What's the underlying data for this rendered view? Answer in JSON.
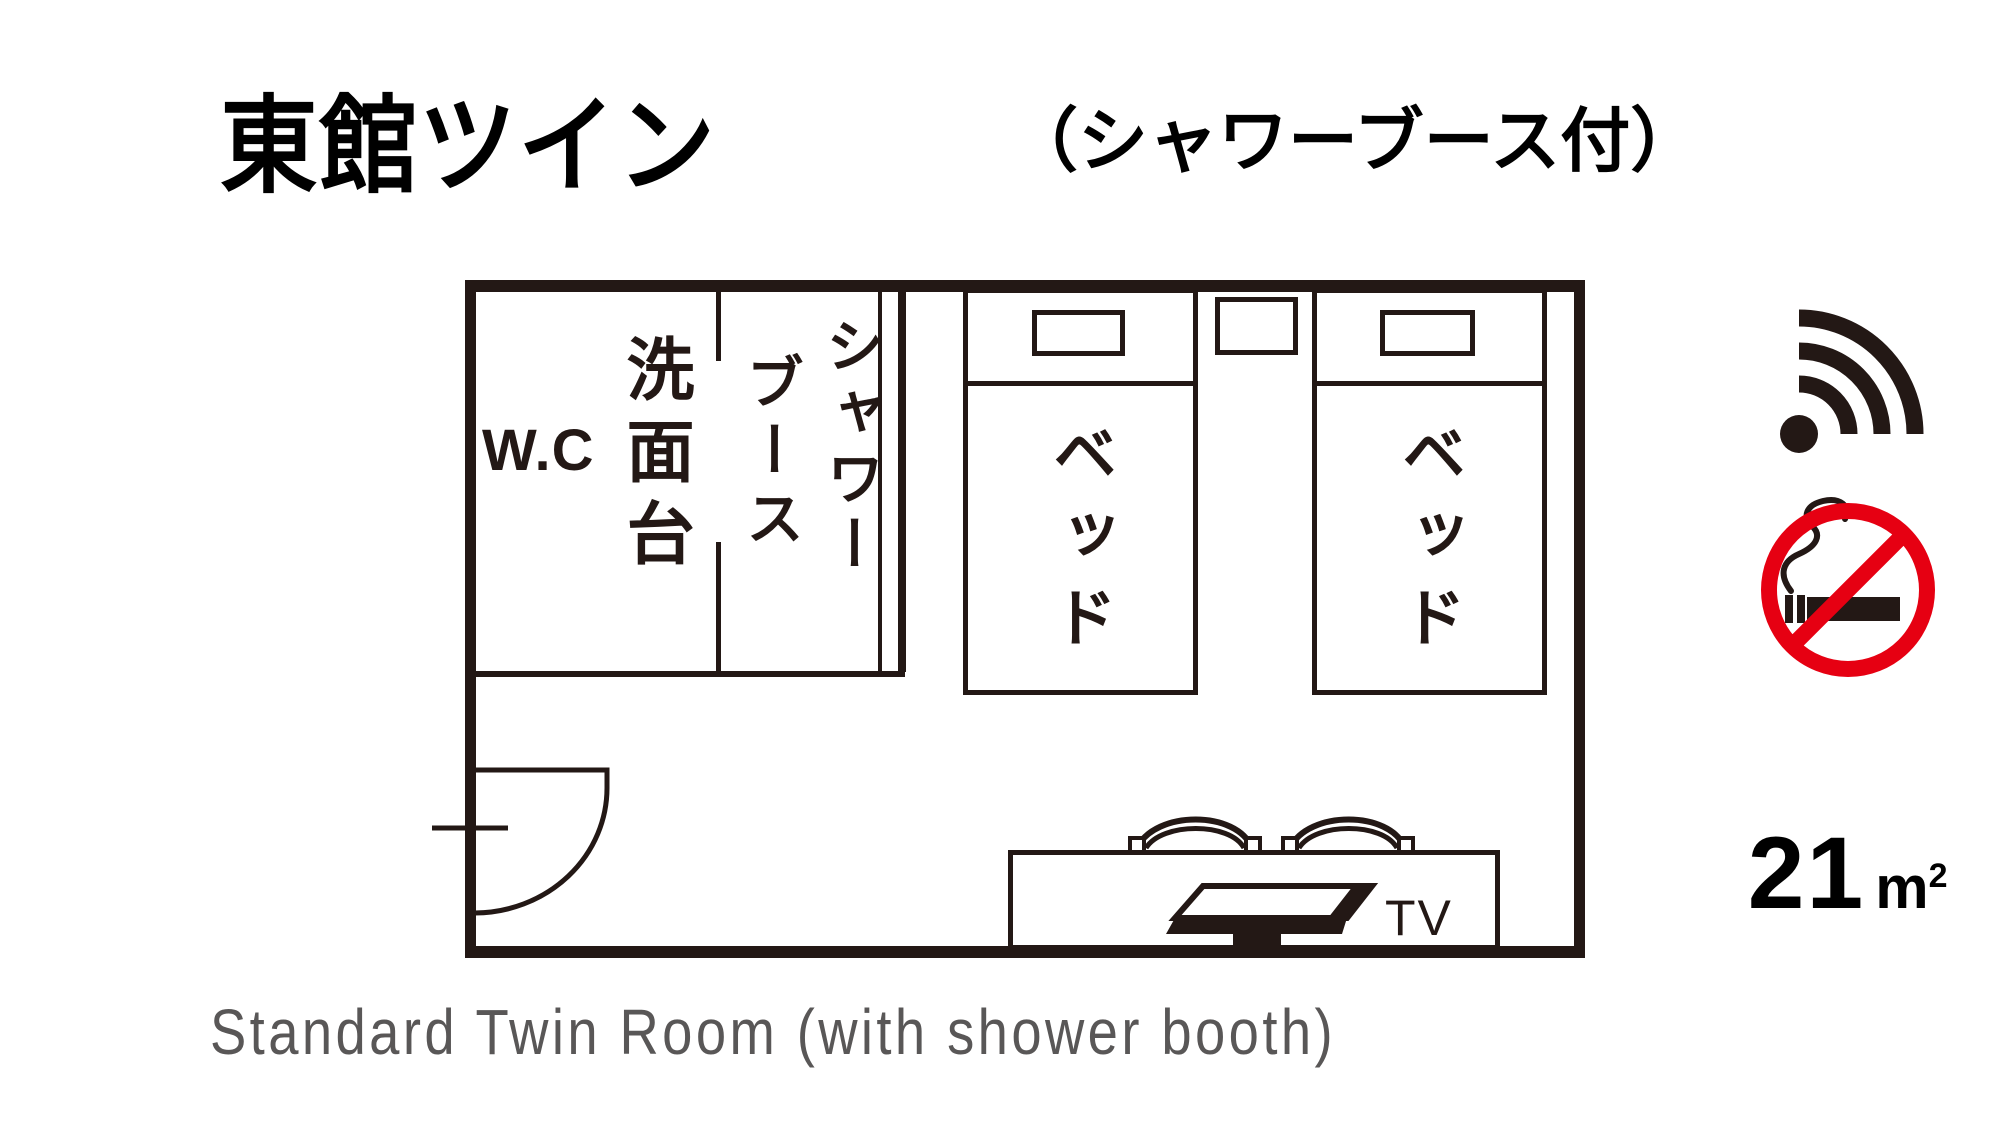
{
  "title": "東館ツイン",
  "subtitle": "（シャワーブース付）",
  "caption": "Standard Twin Room (with shower booth)",
  "area": {
    "value": "21",
    "unit_base": "m",
    "unit_exponent": "2"
  },
  "floorplan": {
    "wc_label": "W.C",
    "washstand_label": "洗面台",
    "shower_label_line1": "シャワー",
    "shower_label_line2": "ブース",
    "bed_labels": [
      "ベッド",
      "ベッド"
    ],
    "tv_label": "TV"
  },
  "icons": {
    "wifi": "wifi-icon",
    "no_smoking": "no-smoking-icon",
    "door": "door-swing-icon",
    "tv": "tv-icon",
    "chairs": "chair-icon"
  },
  "colors": {
    "ink": "#000000",
    "line": "#231815",
    "sign_red": "#e60012",
    "caption_gray": "#595757"
  }
}
